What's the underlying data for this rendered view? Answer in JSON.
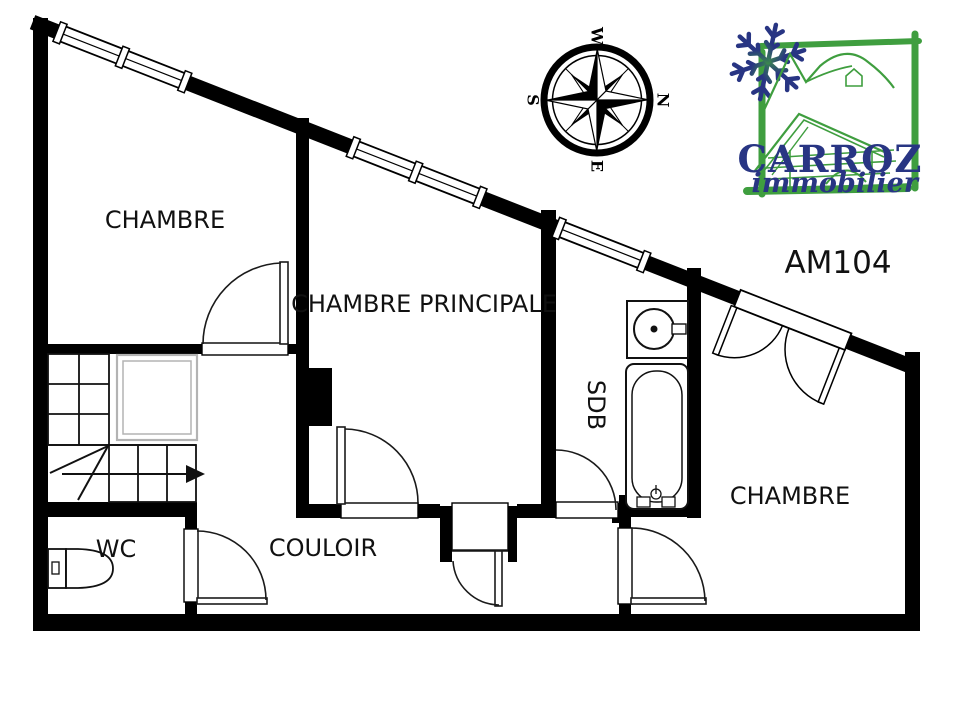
{
  "plan": {
    "reference": "AM104",
    "rooms": {
      "chambre_top": "CHAMBRE",
      "chambre_principale": "CHAMBRE PRINCIPALE",
      "sdb": "SDB",
      "chambre_right": "CHAMBRE",
      "wc": "WC",
      "couloir": "COULOIR"
    }
  },
  "compass": {
    "north": "N",
    "south": "S",
    "east": "E",
    "west": "W"
  },
  "logo": {
    "brand": "CARROZ",
    "tagline": "immobilier"
  },
  "colors": {
    "wall": "#000000",
    "background": "#ffffff",
    "stair_void": "#b3b3b3",
    "logo_green": "#3f9e3f",
    "logo_blue": "#283583"
  }
}
